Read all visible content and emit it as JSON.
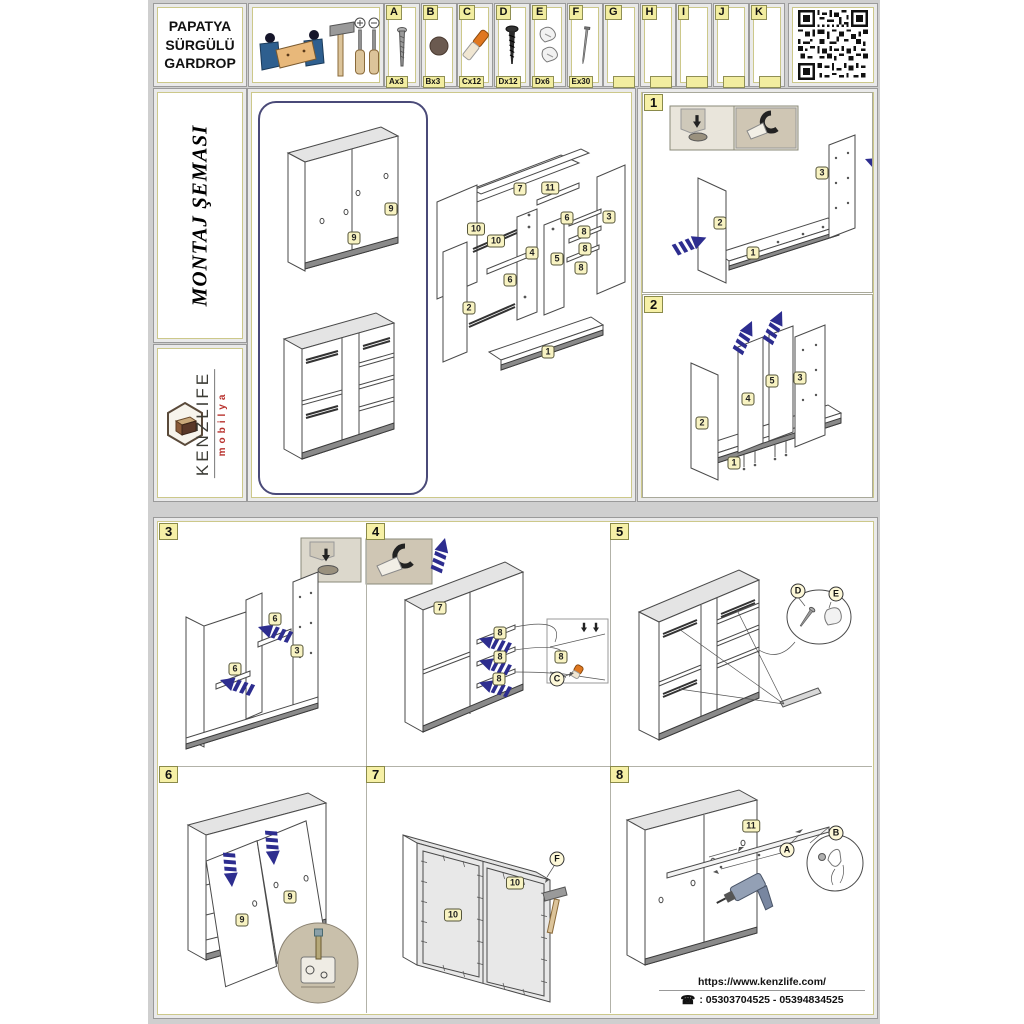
{
  "header": {
    "title_lines": [
      "PAPATYA",
      "SÜRGÜLÜ",
      "GARDROP"
    ],
    "hardware": [
      {
        "letter": "A",
        "count": "Ax3",
        "icon": "long-screw-icon"
      },
      {
        "letter": "B",
        "count": "Bx3",
        "icon": "cam-cap-icon"
      },
      {
        "letter": "C",
        "count": "Cx12",
        "icon": "orange-dowel-icon"
      },
      {
        "letter": "D",
        "count": "Dx12",
        "icon": "black-screw-icon"
      },
      {
        "letter": "E",
        "count": "Dx6",
        "icon": "plastic-clip-icon"
      },
      {
        "letter": "F",
        "count": "Ex30",
        "icon": "nail-icon"
      },
      {
        "letter": "G",
        "count": "",
        "icon": ""
      },
      {
        "letter": "H",
        "count": "",
        "icon": ""
      },
      {
        "letter": "I",
        "count": "",
        "icon": ""
      },
      {
        "letter": "J",
        "count": "",
        "icon": ""
      },
      {
        "letter": "K",
        "count": "",
        "icon": ""
      }
    ]
  },
  "sidebar": {
    "schema_title": "MONTAJ ŞEMASI",
    "brand": "KENZLIFE",
    "brand_sub": "mobilya"
  },
  "overview": {
    "closed_tags": [
      "9",
      "9"
    ],
    "exploded_tags": [
      "7",
      "11",
      "10",
      "10",
      "2",
      "4",
      "6",
      "6",
      "5",
      "3",
      "8",
      "8",
      "8",
      "1"
    ]
  },
  "steps": {
    "s1": {
      "num": "1",
      "tags": [
        "2",
        "1",
        "3"
      ]
    },
    "s2": {
      "num": "2",
      "tags": [
        "2",
        "4",
        "5",
        "3",
        "1"
      ]
    },
    "s3": {
      "num": "3",
      "tags": [
        "6",
        "3",
        "6"
      ]
    },
    "s4": {
      "num": "4",
      "tags": [
        "7",
        "8",
        "8",
        "8"
      ],
      "detail_tag": "8",
      "detail_letter": "C"
    },
    "s5": {
      "num": "5",
      "letters": [
        "D",
        "E"
      ]
    },
    "s6": {
      "num": "6",
      "tags": [
        "9",
        "9"
      ]
    },
    "s7": {
      "num": "7",
      "tags": [
        "10",
        "10"
      ],
      "letter": "F"
    },
    "s8": {
      "num": "8",
      "tags": [
        "11"
      ],
      "letters": [
        "A",
        "B"
      ]
    }
  },
  "footer": {
    "website": "https://www.kenzlife.com/",
    "phones": ": 05303704525 - 05394834525",
    "phone_icon": "☎"
  }
}
